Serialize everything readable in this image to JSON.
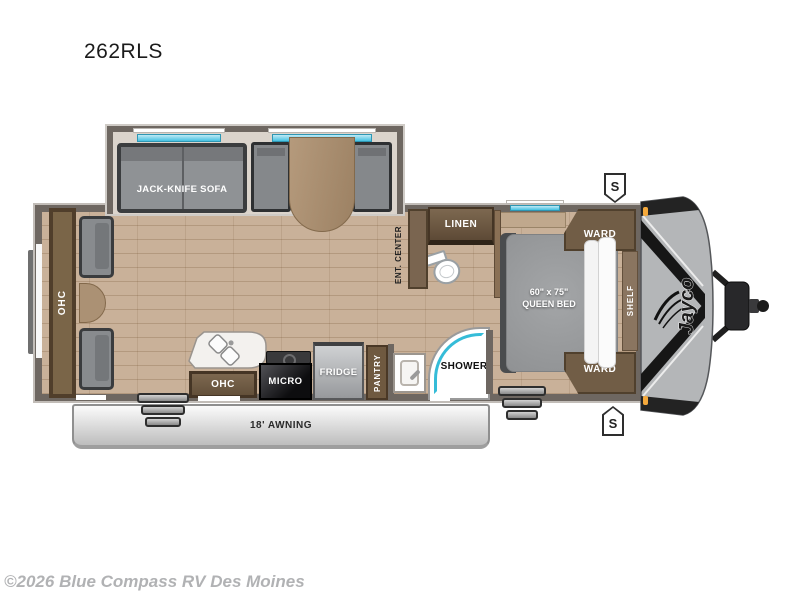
{
  "title": "262RLS",
  "brand": {
    "name": "Jayco"
  },
  "badges": {
    "top": "S",
    "bottom": "S"
  },
  "rooms": {
    "sofa": "JACK-KNIFE SOFA",
    "rear_ohc": "OHC",
    "ent_center": "ENT. CENTER",
    "linen": "LINEN",
    "ward_top": "WARD",
    "ward_bottom": "WARD",
    "shelf": "SHELF",
    "bed_size": "60\" x 75\"",
    "bed_type": "QUEEN BED",
    "shower": "SHOWER",
    "pantry": "PANTRY",
    "fridge": "FRIDGE",
    "micro": "MICRO",
    "kitchen_ohc": "OHC",
    "awning": "18' AWNING"
  },
  "footer": {
    "copyright": "©2026 Blue Compass RV Des Moines"
  },
  "colors": {
    "window_accent": "#45c2e2",
    "wall": "#6e6761",
    "floor": "#c9b199",
    "cabinet_wood": "#7d6850",
    "front_cap": "#b4b6b8",
    "marker_light": "#f5a93c",
    "copyright_text": "#b1b2b4"
  }
}
